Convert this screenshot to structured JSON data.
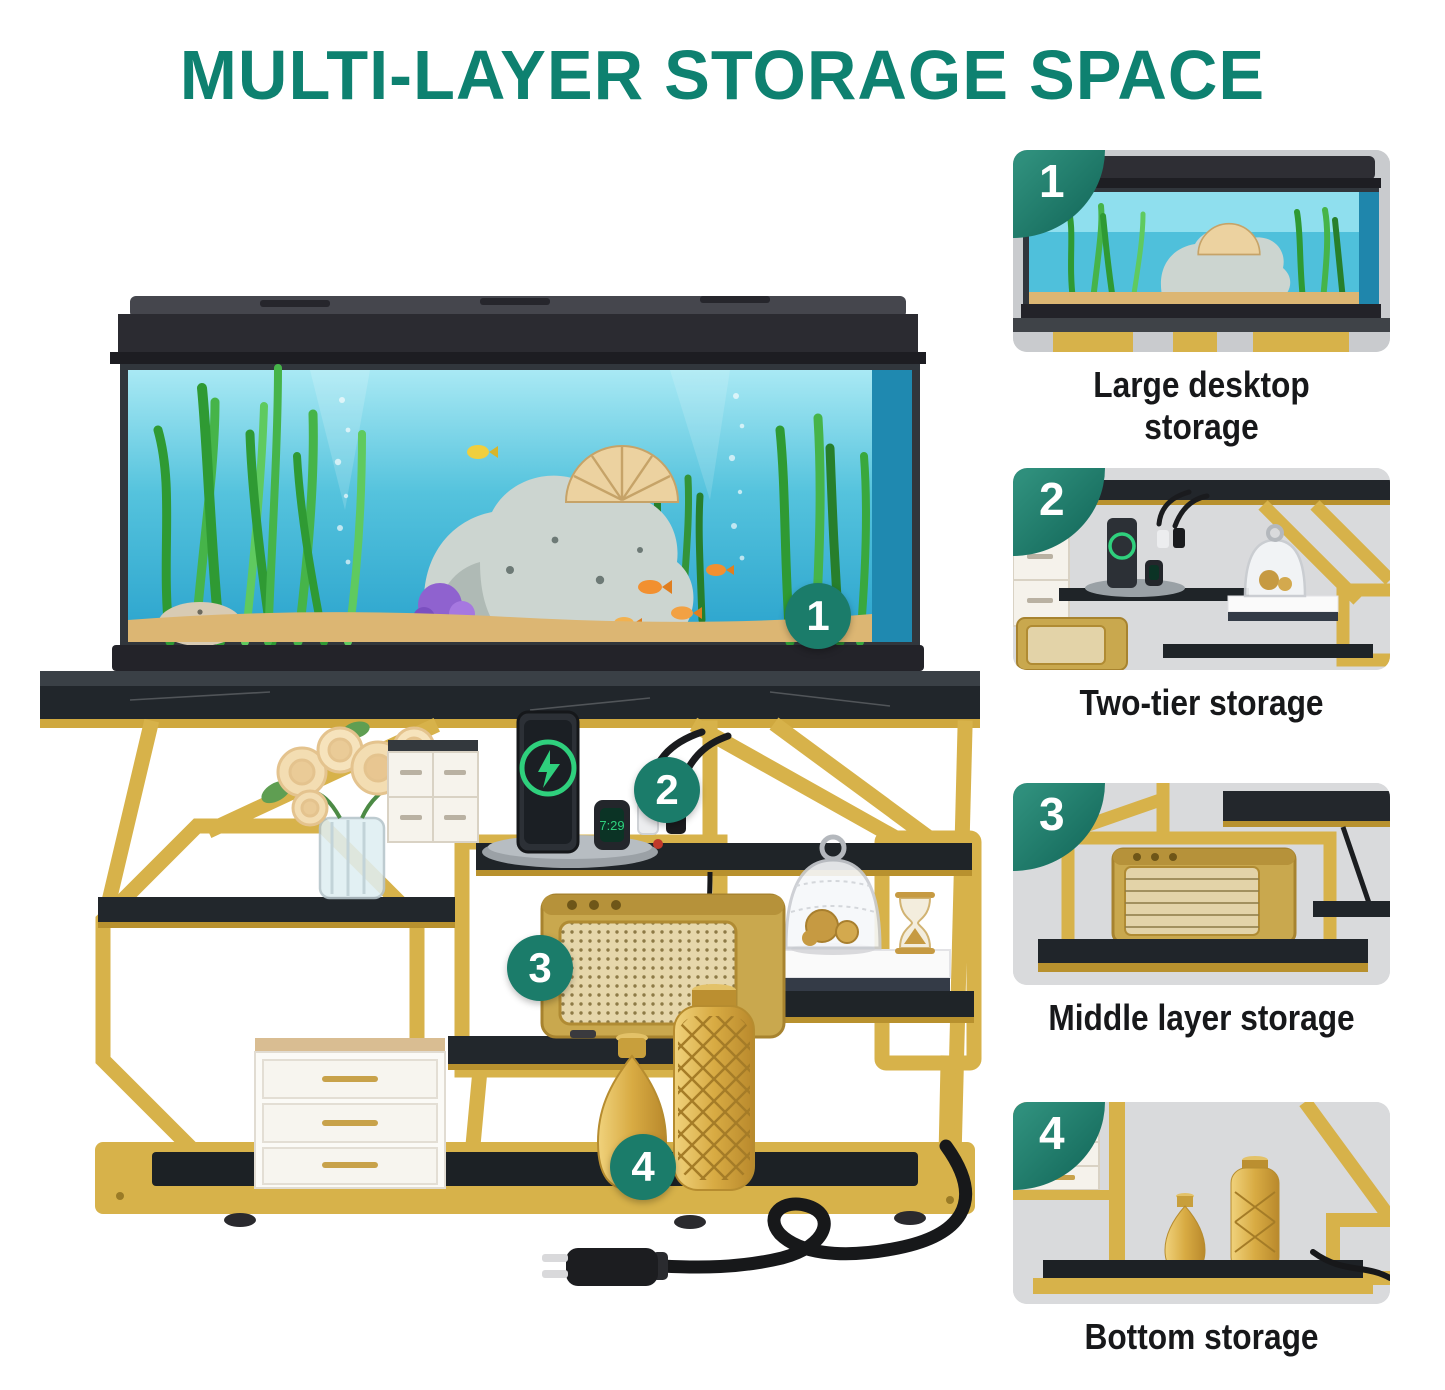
{
  "header": {
    "title": "MULTI-LAYER STORAGE SPACE"
  },
  "main_image": {
    "callouts": [
      "1",
      "2",
      "3",
      "4"
    ]
  },
  "features": [
    {
      "number": "1",
      "caption": "Large desktop storage"
    },
    {
      "number": "2",
      "caption": "Two-tier storage"
    },
    {
      "number": "3",
      "caption": "Middle layer storage"
    },
    {
      "number": "4",
      "caption": "Bottom storage"
    }
  ],
  "colors": {
    "accent_teal": "#0e8170",
    "badge_teal": "#1b7c6a",
    "frame_gold": "#d7b24a",
    "marble_black": "#22262b",
    "caption_text": "#17181a"
  }
}
